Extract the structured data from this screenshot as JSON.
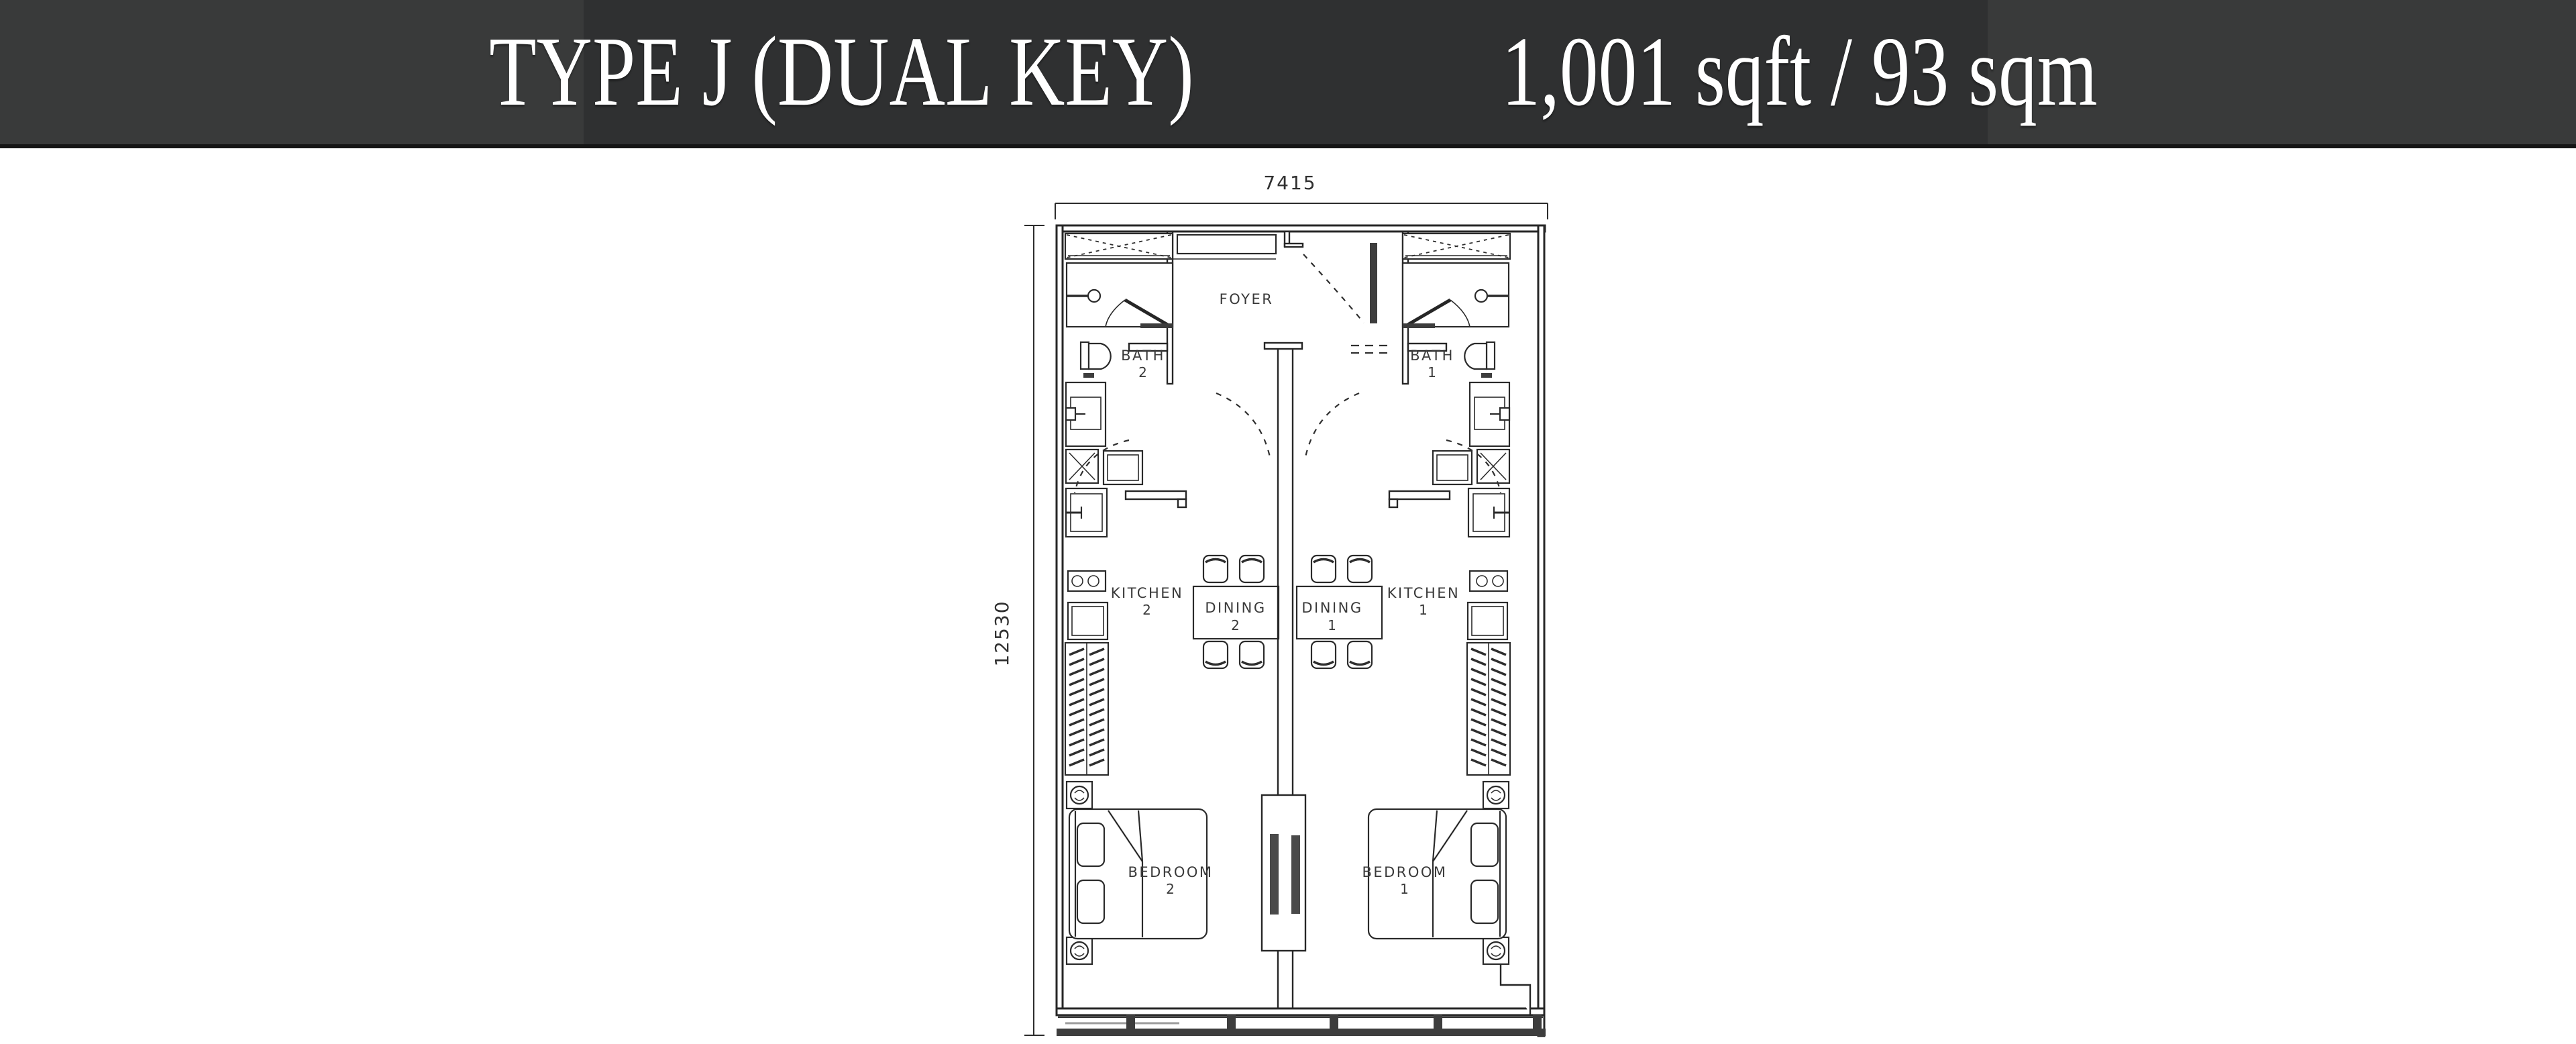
{
  "header": {
    "title": "TYPE J (DUAL KEY)",
    "area": "1,001 sqft / 93 sqm",
    "colors": {
      "bar": "#393a3a",
      "panel": "#2f3031",
      "text": "#ffffff",
      "edge": "#151515"
    }
  },
  "plan": {
    "dimensions": {
      "width": "7415",
      "depth": "12530"
    },
    "rooms": {
      "foyer": {
        "label": "FOYER"
      },
      "bath2": {
        "label": "BATH",
        "number": "2"
      },
      "bath1": {
        "label": "BATH",
        "number": "1"
      },
      "kitchen2": {
        "label": "KITCHEN",
        "number": "2"
      },
      "kitchen1": {
        "label": "KITCHEN",
        "number": "1"
      },
      "dining2": {
        "label": "DINING",
        "number": "2"
      },
      "dining1": {
        "label": "DINING",
        "number": "1"
      },
      "bedroom2": {
        "label": "BEDROOM",
        "number": "2"
      },
      "bedroom1": {
        "label": "BEDROOM",
        "number": "1"
      }
    },
    "icons": [
      "closet-icon",
      "shower-icon",
      "toilet-icon",
      "vanity-sink-icon",
      "washer-icon",
      "counter-icon",
      "kitchen-sink-icon",
      "hob-icon",
      "fridge-icon",
      "tall-cabinet-icon",
      "ceiling-fan-icon",
      "bed-icon",
      "dining-table-icon",
      "chair-icon",
      "sliding-door-icon",
      "door-swing-arc-icon",
      "window-band-icon"
    ],
    "colors": {
      "line": "#262626",
      "label": "#3a3a3a",
      "dark_fill": "#3d3d3d",
      "background": "#ffffff"
    }
  }
}
